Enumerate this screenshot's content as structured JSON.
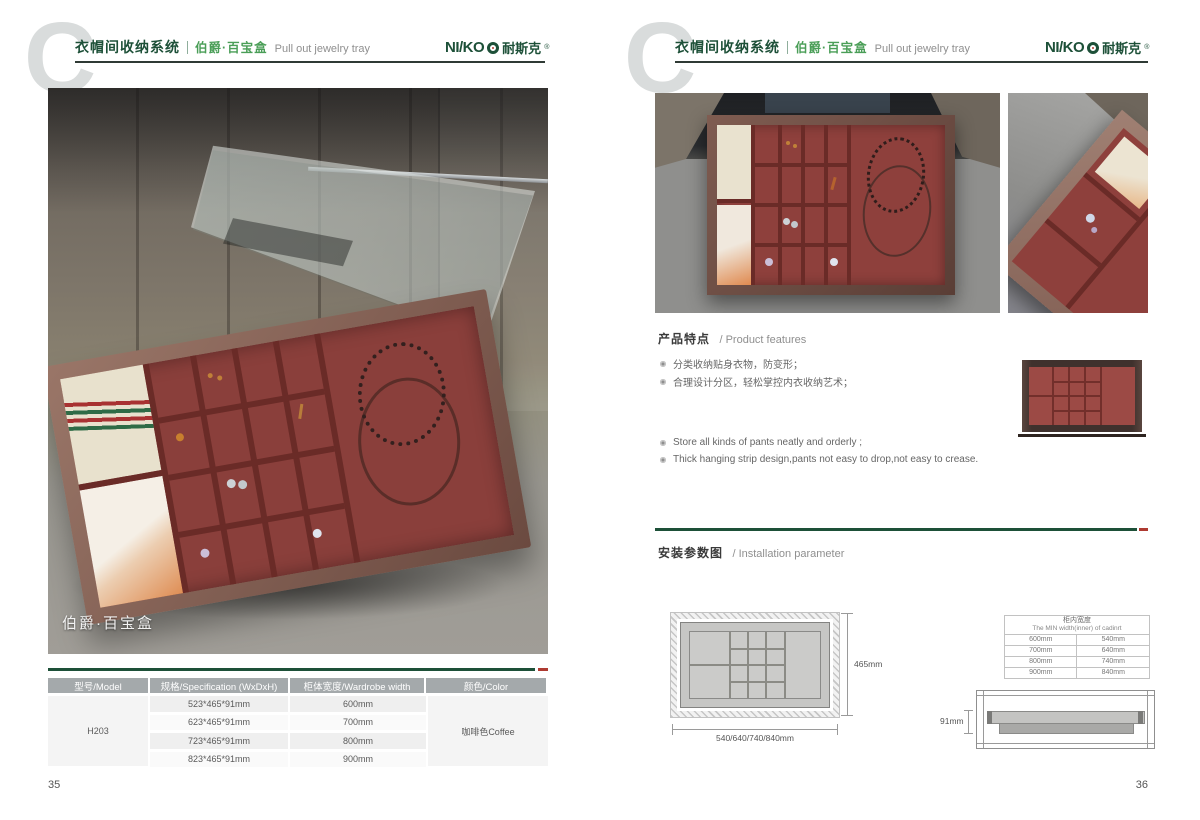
{
  "header": {
    "category": "衣帽间收纳系统",
    "product_cn": "伯爵·百宝盒",
    "product_en": "Pull out jewelry tray",
    "watermark": "C",
    "logo": {
      "text": "NI/KO",
      "cn": "耐斯克",
      "reg": "®"
    }
  },
  "left_page": {
    "photo_label": "伯爵·百宝盒",
    "page_number": "35",
    "table": {
      "headers": [
        "型号/Model",
        "规格/Specification (WxDxH)",
        "柜体宽度/Wardrobe width",
        "颜色/Color"
      ],
      "model": "H203",
      "rows": [
        {
          "spec": "523*465*91mm",
          "width": "600mm"
        },
        {
          "spec": "623*465*91mm",
          "width": "700mm"
        },
        {
          "spec": "723*465*91mm",
          "width": "800mm"
        },
        {
          "spec": "823*465*91mm",
          "width": "900mm"
        }
      ],
      "color": "咖啡色Coffee"
    }
  },
  "right_page": {
    "page_number": "36",
    "features": {
      "title_cn": "产品特点",
      "title_en": "/ Product features",
      "bullets_cn": [
        "分类收纳贴身衣物，防变形；",
        "合理设计分区，轻松掌控内衣收纳艺术；"
      ],
      "bullets_en": [
        "Store all kinds of pants neatly and orderly ;",
        "Thick hanging strip design,pants not easy to drop,not easy to crease."
      ]
    },
    "installation": {
      "title_cn": "安装参数图",
      "title_en": "/ Installation parameter",
      "top_view": {
        "height_label": "465mm",
        "width_label": "540/640/740/840mm"
      },
      "side_view": {
        "height_label": "91mm"
      },
      "width_table": {
        "title_cn": "柜内宽度",
        "title_en": "The MIN width(inner) of cadinrt",
        "rows": [
          [
            "600mm",
            "540mm"
          ],
          [
            "700mm",
            "640mm"
          ],
          [
            "800mm",
            "740mm"
          ],
          [
            "900mm",
            "840mm"
          ]
        ]
      }
    }
  },
  "colors": {
    "brand_green": "#1d5038",
    "light_green": "#4a9e57",
    "accent_red": "#ae3a31",
    "tray_maroon": "#8e403c",
    "frame_brown": "#7b5a50",
    "table_header_gray": "#a4a9ab"
  }
}
